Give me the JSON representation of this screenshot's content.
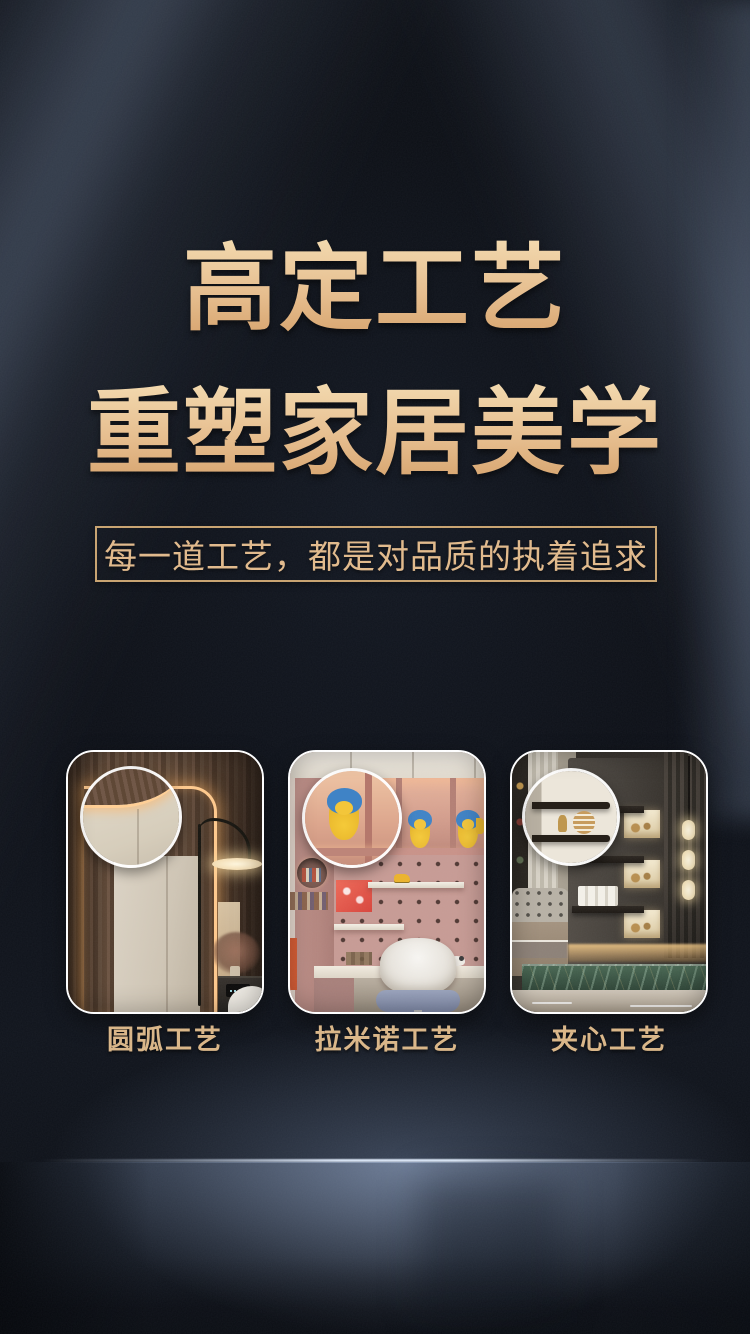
{
  "hero": {
    "title_line1": "高定工艺",
    "title_line2": "重塑家居美学",
    "subtitle": "每一道工艺，都是对品质的执着追求"
  },
  "craft_cards": [
    {
      "label": "圆弧工艺",
      "scene": "arc-corner-wardrobe"
    },
    {
      "label": "拉米诺工艺",
      "scene": "lamello-kids-study"
    },
    {
      "label": "夹心工艺",
      "scene": "sandwich-floating-shelves"
    }
  ],
  "colors": {
    "background": "#0c0f15",
    "gold_light": "#f4daae",
    "gold": "#e3bb8a",
    "gold_dark": "#d6a169",
    "beam_blue": "#91a5c6",
    "floor_glow": "#9eb2d4",
    "card_border": "#ffffff"
  }
}
